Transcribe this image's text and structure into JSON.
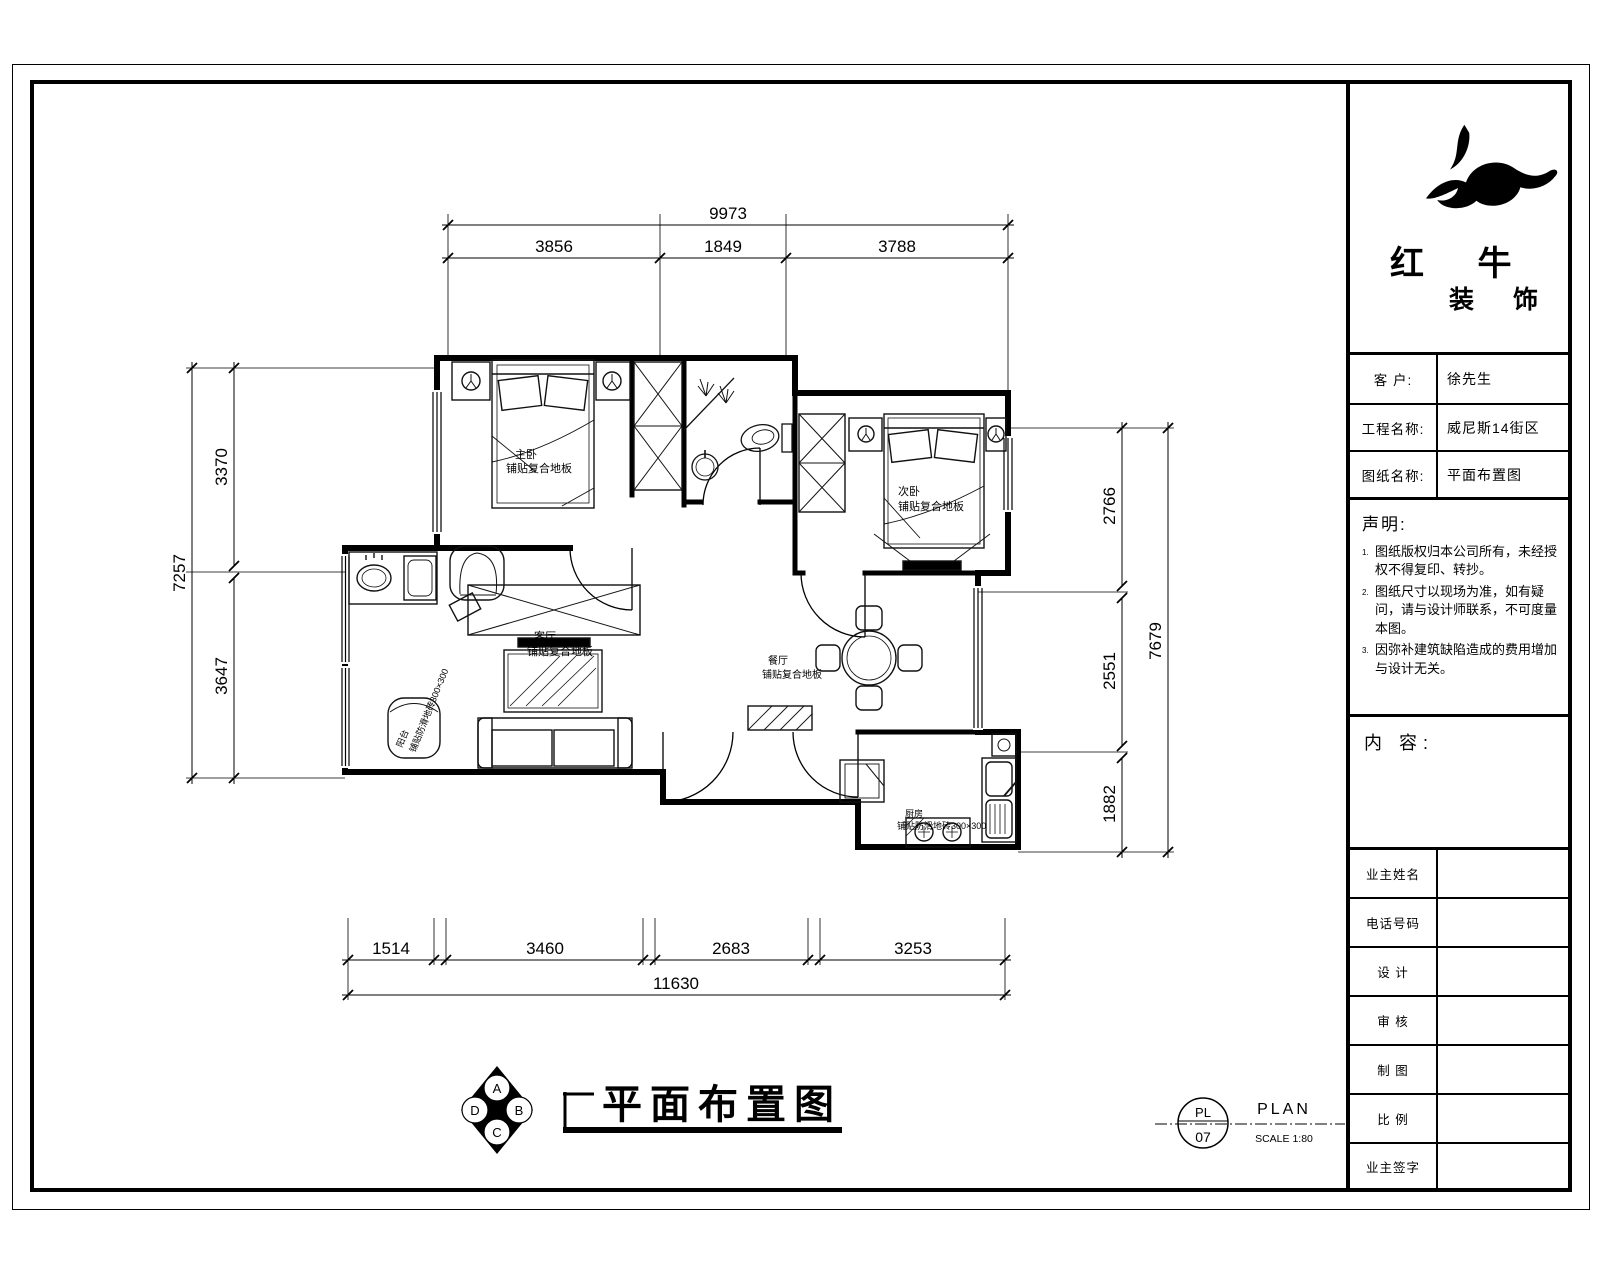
{
  "company": {
    "name": "红 牛",
    "sub": "装 饰"
  },
  "title_block": {
    "rows": [
      {
        "label": "客  户:",
        "value": "徐先生"
      },
      {
        "label": "工程名称:",
        "value": "威尼斯14街区"
      },
      {
        "label": "图纸名称:",
        "value": "平面布置图"
      }
    ],
    "statement": {
      "title": "声明:",
      "items": [
        {
          "no": "1.",
          "text": "图纸版权归本公司所有，未经授权不得复印、转抄。"
        },
        {
          "no": "2.",
          "text": "图纸尺寸以现场为准，如有疑问，请与设计师联系，不可度量本图。"
        },
        {
          "no": "3.",
          "text": "因弥补建筑缺陷造成的费用增加与设计无关。"
        }
      ]
    },
    "content_label": "内 容:",
    "form_rows": [
      "业主姓名",
      "电话号码",
      "设  计",
      "审  核",
      "制  图",
      "比  例",
      "业主签字"
    ]
  },
  "dims": {
    "top": {
      "total": "9973",
      "segments": [
        "3856",
        "1849",
        "3788"
      ]
    },
    "left": {
      "total": "7257",
      "segments": [
        "3370",
        "3647"
      ]
    },
    "right": {
      "total": "7679",
      "segments": [
        "2766",
        "2551",
        "1882"
      ]
    },
    "bottom": {
      "total": "11630",
      "segments": [
        "1514",
        "3460",
        "2683",
        "3253"
      ]
    }
  },
  "rooms": {
    "bedroom1": {
      "name": "主卧",
      "finish": "铺贴复合地板"
    },
    "bedroom2": {
      "name": "次卧",
      "finish": "铺贴复合地板"
    },
    "living": {
      "name": "客厅",
      "finish": "铺贴复合地板"
    },
    "dining": {
      "name": "餐厅",
      "finish": "铺贴复合地板"
    },
    "kitchen": {
      "name": "厨房",
      "finish": "铺贴防滑地砖300×300"
    },
    "balcony": {
      "name": "阳台",
      "finish": "铺贴防滑地砖300×300"
    }
  },
  "drawing": {
    "title": "平面布置图"
  },
  "stamp": {
    "circle_top": "PL",
    "circle_bottom": "07",
    "label": "PLAN",
    "scale": "SCALE 1:80"
  },
  "compass": {
    "n": "A",
    "e": "B",
    "s": "C",
    "w": "D"
  }
}
